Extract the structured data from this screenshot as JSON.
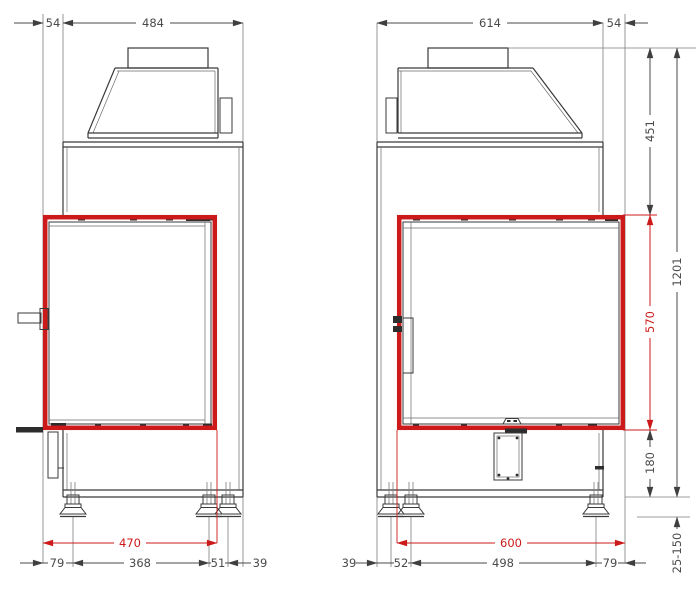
{
  "colors": {
    "dimension_red": "#cc1a1a",
    "line_dark": "#3a3a3a",
    "dimension_gray": "#4a4a4a"
  },
  "left_view": {
    "top": {
      "offset": "54",
      "depth": "484"
    },
    "glass": {
      "depth": "470"
    },
    "bottom": {
      "front_foot": "79",
      "foot_span": "368",
      "foot_gap": "51",
      "rear": "39"
    }
  },
  "right_view": {
    "top": {
      "width": "614",
      "offset": "54"
    },
    "glass": {
      "width": "600"
    },
    "bottom": {
      "rear": "39",
      "foot_gap": "52",
      "foot_span": "498",
      "front_foot": "79"
    }
  },
  "heights": {
    "top_to_glass": "451",
    "glass_height": "570",
    "below_glass": "180",
    "total": "1201",
    "feet_range": "25-150"
  }
}
